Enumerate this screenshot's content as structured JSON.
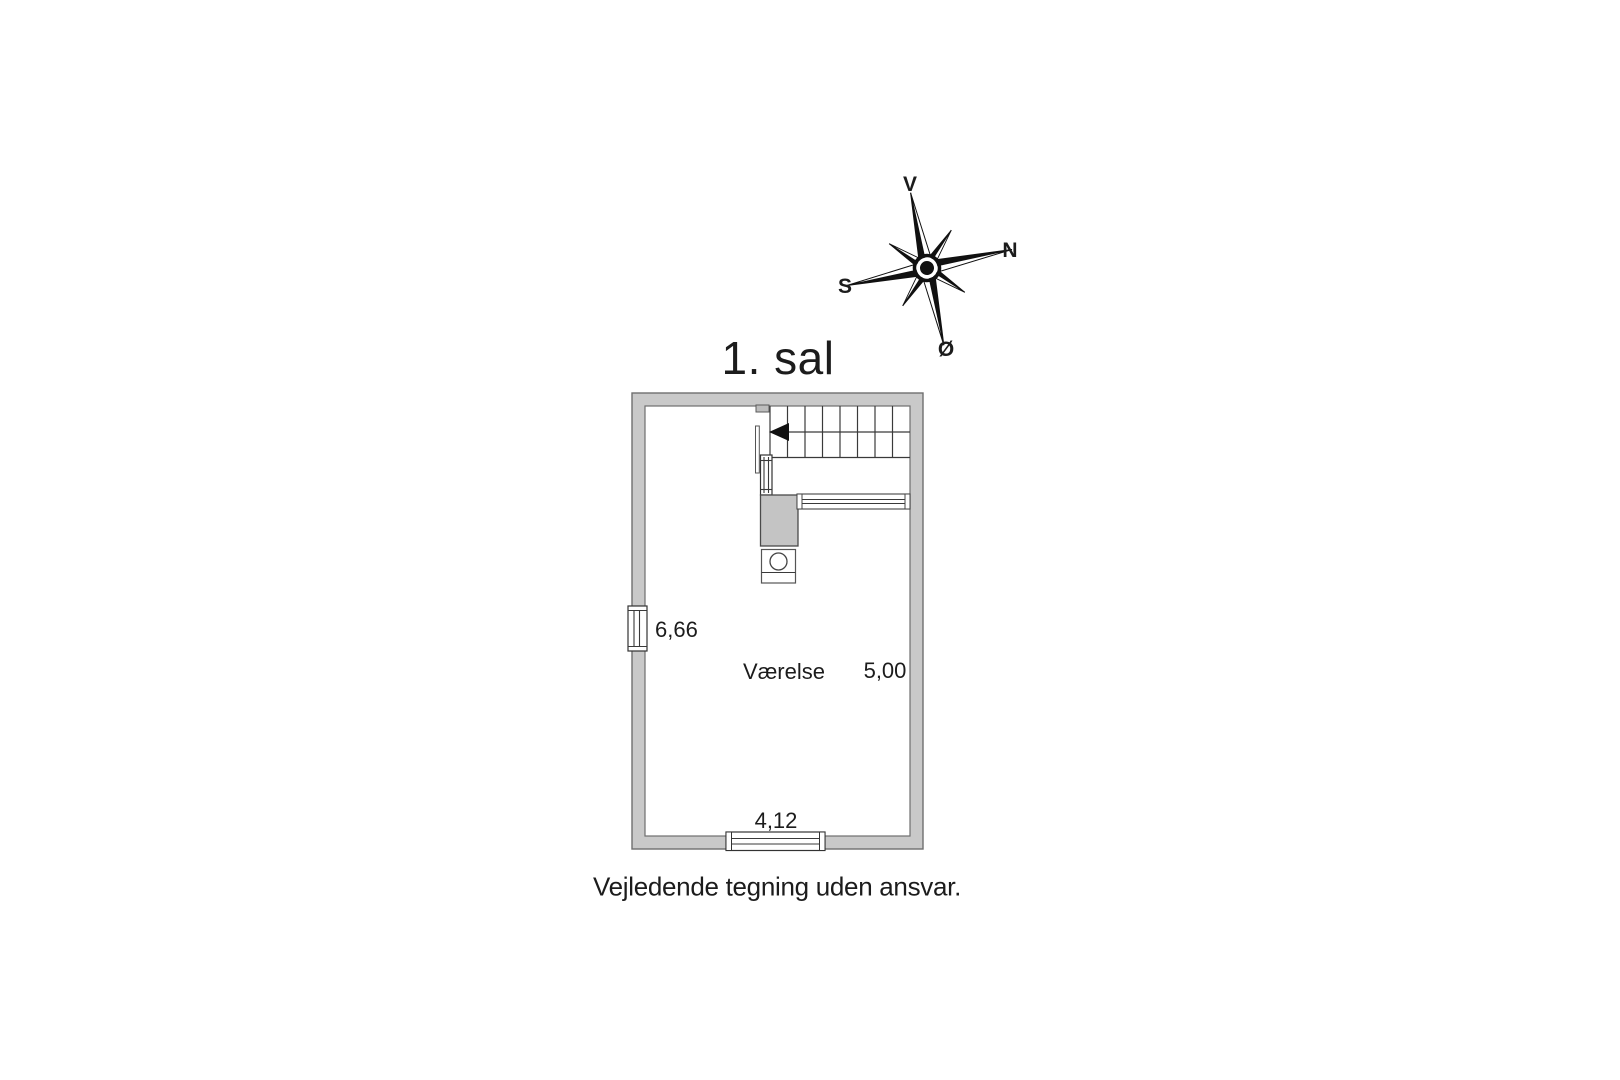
{
  "page": {
    "background": "#ffffff",
    "disclaimer": "Vejledende tegning uden ansvar."
  },
  "floor_plan": {
    "title": "1. sal",
    "room_label": "Værelse",
    "dimensions": {
      "left_height": "6,66",
      "right_height": "5,00",
      "bottom_width": "4,12"
    },
    "features": {
      "stairs": "stairs-with-left-arrow",
      "stair_arrow_icon": "left-arrow-icon",
      "chimney": "chimney-block",
      "fixture": "fixture-with-circle",
      "left_window": "window",
      "bottom_window": "window",
      "railing": "railing"
    },
    "colors": {
      "wall_fill": "#c9c9c9",
      "wall_outline": "#6f6f6f",
      "feature_fill": "#c4c4c4",
      "line": "#3a3a3a",
      "text": "#1c1c1c"
    }
  },
  "compass": {
    "icon": "compass-rose-icon",
    "labels": {
      "up": "V",
      "right": "N",
      "left": "S",
      "down": "Ø"
    }
  }
}
